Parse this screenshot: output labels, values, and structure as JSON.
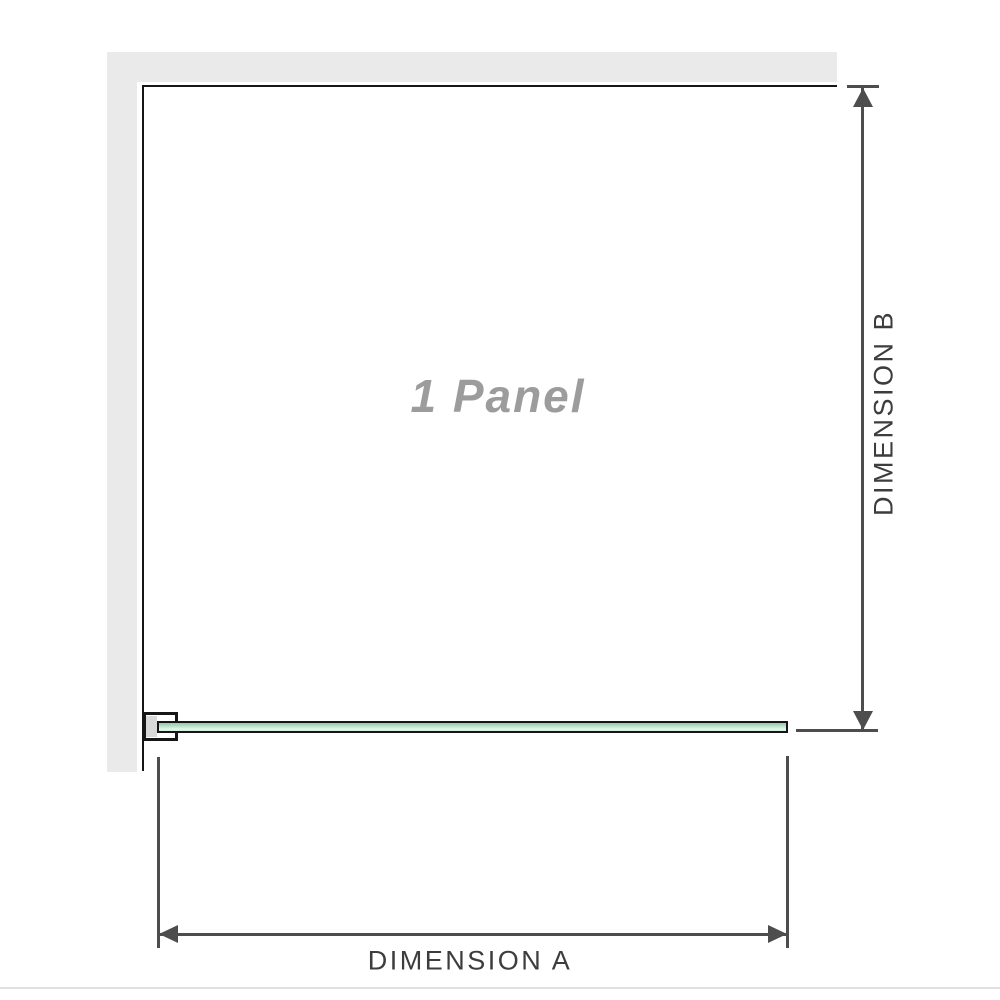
{
  "diagram": {
    "panel_label": "1 Panel",
    "dimension_a_label": "DIMENSION A",
    "dimension_b_label": "DIMENSION B"
  },
  "colors": {
    "wall": "#eaeaea",
    "outline": "#161616",
    "dimension": "#4d4d4d",
    "label_text": "#3d3d3d",
    "panel_label_text": "#9c9c9c",
    "glass_top": "#8fcbaa",
    "glass_mid": "#b9e2c9",
    "glass_light": "#e9f7ef",
    "glass_bottom": "#cfe9d9",
    "bracket_pad": "#d9d9d9",
    "bottom_rule": "#e0e0e0"
  }
}
